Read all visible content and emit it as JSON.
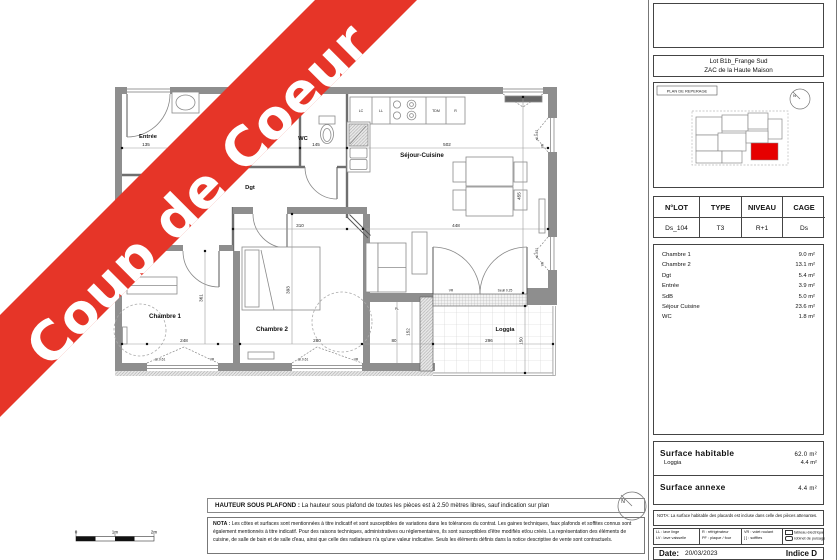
{
  "banner": {
    "text": "Coup de Coeur"
  },
  "colors": {
    "banner_red": "#e63528",
    "highlight_red": "#e60000"
  },
  "plan": {
    "rooms": {
      "entree": "Entrée",
      "wc": "WC",
      "dgt": "Dgt",
      "sejour": "Séjour-Cuisine",
      "ch1": "Chambre 1",
      "ch2": "Chambre 2",
      "loggia": "Loggia",
      "pl": "PL"
    },
    "kitchen": {
      "lc": "LC",
      "ll": "LL",
      "tdm": "TDM",
      "r": "R"
    },
    "dims": {
      "entree": "135",
      "wc": "145",
      "sejour_w": "502",
      "dgt": "310",
      "sejour_inner": "448",
      "sejour_h": "455",
      "ch1_h": "361",
      "ch2_h": "393",
      "ch1_win": "248",
      "ch2_win": "280",
      "loggia_w": "296",
      "loggia_h": "150",
      "pl_h": "152",
      "pl_w": "80",
      "allege": "all.0.61",
      "vr": "VR",
      "seuil": "Seuil 0.25"
    },
    "scalebar": {
      "t0": "0",
      "t1": "1m",
      "t2": "2m"
    },
    "north": "N"
  },
  "footer": {
    "hsp_label": "HAUTEUR SOUS PLAFOND :",
    "hsp_text": "La hauteur sous plafond de toutes les pièces est à 2.50 mètres libres, sauf indication sur plan",
    "nota_label": "NOTA :",
    "nota_text": "Les côtes et surfaces sont mentionnées à titre indicatif et sont susceptibles de variations dans les tolérances du contrat. Les gaines techniques, faux plafonds et soffites connus sont également mentionnés à titre indicatif. Pour des raisons techniques, administratives ou réglementaires, ils sont susceptibles d'être modifiés et/ou créés. La représentation des éléments de cuisine, de salle de bain et de salle d'eau, ainsi que celle des radiateurs n'a qu'une valeur indicative. Seuls les éléments définis dans la notice descriptive de vente sont contractuels."
  },
  "sidebar": {
    "project_line1": "Lot B1b_Frange Sud",
    "project_line2": "ZAC de la Haute Maison",
    "reperage_title": "PLAN DE REPERAGE",
    "lot_table": {
      "headers": [
        "N°LOT",
        "TYPE",
        "NIVEAU",
        "CAGE"
      ],
      "values": [
        "Ds_104",
        "T3",
        "R+1",
        "Ds"
      ]
    },
    "areas": [
      {
        "label": "Chambre 1",
        "value": "9.0 m²"
      },
      {
        "label": "Chambre 2",
        "value": "13.1 m²"
      },
      {
        "label": "Dgt",
        "value": "5.4 m²"
      },
      {
        "label": "Entrée",
        "value": "3.9 m²"
      },
      {
        "label": "SdB",
        "value": "5.0 m²"
      },
      {
        "label": "Séjour Cuisine",
        "value": "23.6 m²"
      },
      {
        "label": "WC",
        "value": "1.8 m²"
      }
    ],
    "surface_habitable_label": "Surface  habitable",
    "surface_habitable_value": "62.0 m²",
    "loggia_label": "Loggia",
    "loggia_value": "4.4 m²",
    "surface_annexe_label": "Surface  annexe",
    "surface_annexe_value": "4.4 m²",
    "nota": "NOTA: La surface habitable des placards est incluse dans celle des pièces attenantes.",
    "legend": [
      {
        "l1": "LL : lave linge",
        "l2": "LV : lave vaisselle"
      },
      {
        "l1": "R : réfrigérateur",
        "l2": "PF : plaque / four"
      },
      {
        "l1": "VR : volet roulant",
        "l2": "[  ] : soffites"
      },
      {
        "l1": "tableau électrique abonné",
        "l2": "robinet de puisage"
      }
    ],
    "date_label": "Date:",
    "date_value": "20/03/2023",
    "indice": "Indice D"
  }
}
